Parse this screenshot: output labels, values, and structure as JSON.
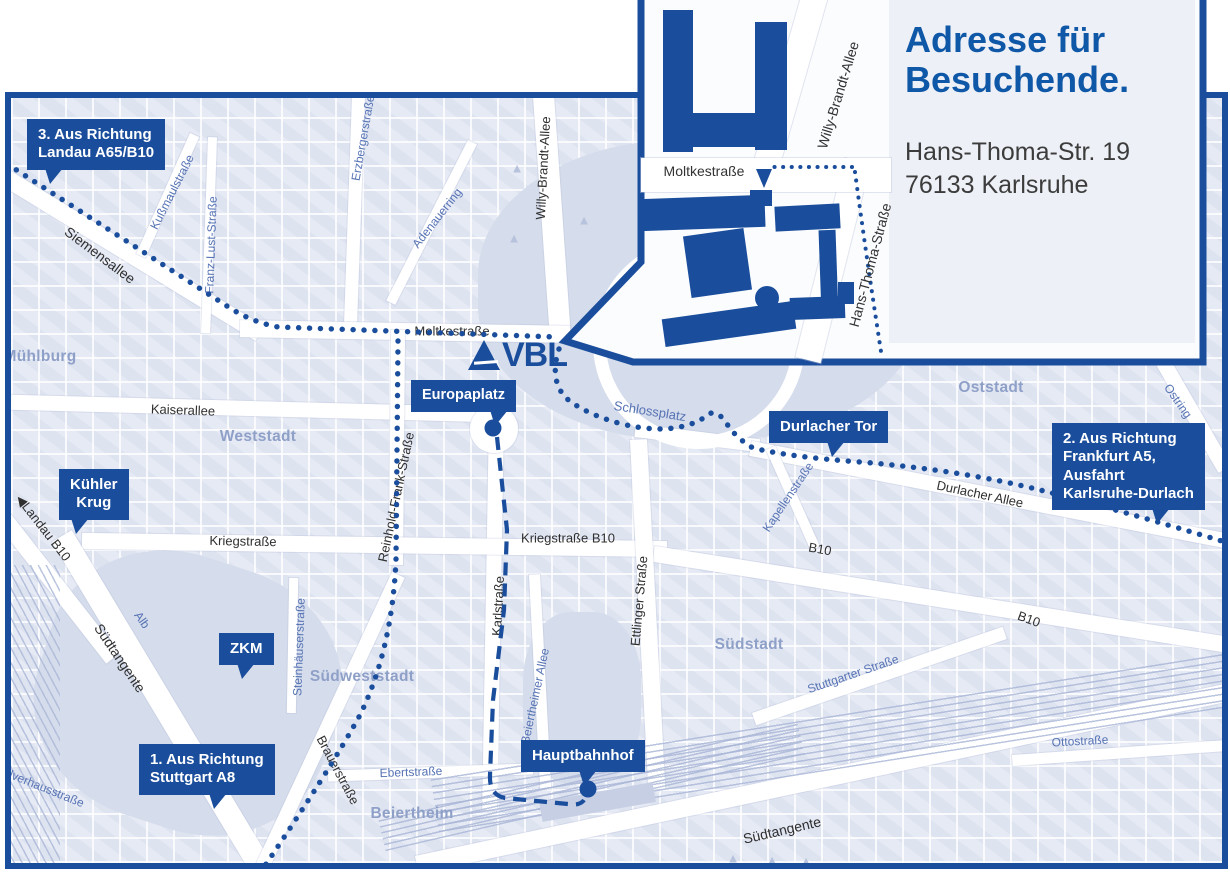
{
  "colors": {
    "brand_blue": "#1a4e9c",
    "title_blue": "#0f57a7",
    "map_block": "#dfe4f0",
    "map_park": "#d5dceb",
    "district_label": "#8fa0c8",
    "street_label_blue": "#5673b4",
    "street_label_dark": "#2f2f2f"
  },
  "logo": {
    "name": "VBL"
  },
  "icons": {
    "tree": "▲",
    "direction_arrow": "◀"
  },
  "inset": {
    "title_line1": "Adresse für",
    "title_line2": "Besuchende.",
    "address_line1": "Hans-Thoma-Str. 19",
    "address_line2": "76133 Karlsruhe",
    "streets": {
      "moltkestrasse": "Moltkestraße",
      "willy_brandt_allee": "Willy-Brandt-Allee",
      "hans_thoma_strasse": "Hans-Thoma-Straße"
    }
  },
  "badges": {
    "landau": {
      "line1": "3. Aus Richtung",
      "line2": "Landau A65/B10"
    },
    "kuehler_krug": {
      "line1": "Kühler",
      "line2": "Krug"
    },
    "zkm": {
      "line1": "ZKM"
    },
    "stuttgart": {
      "line1": "1. Aus Richtung",
      "line2": "Stuttgart A8"
    },
    "europaplatz": {
      "line1": "Europaplatz"
    },
    "durlacher_tor": {
      "line1": "Durlacher Tor"
    },
    "frankfurt": {
      "line1": "2. Aus Richtung",
      "line2": "Frankfurt A5,",
      "line3": "Ausfahrt",
      "line4": "Karlsruhe-Durlach"
    },
    "hauptbahnhof": {
      "line1": "Hauptbahnhof"
    }
  },
  "streets_dark": {
    "siemensallee": "Siemensallee",
    "moltkestrasse": "Moltkestraße",
    "kaiserallee": "Kaiserallee",
    "kriegstrasse": "Kriegstraße",
    "kriegstrasse_b10": "Kriegstraße B10",
    "karlstrasse": "Karlstraße",
    "reinhold_frank": "Reinhold-Frank-Straße",
    "brauerstrasse": "Brauerstraße",
    "durlacher_allee": "Durlacher Allee",
    "b10_mid": "B10",
    "b10_east": "B10",
    "suedtangente_west": "Südtangente",
    "suedtangente_sued": "Südtangente",
    "landau_b10": "Landau B10",
    "willy_brandt_allee": "Willy-Brandt-Allee",
    "ettlinger": "Ettlinger Straße"
  },
  "streets_blue": {
    "kussmaulstrasse": "Kußmaulstraße",
    "franz_lust": "Franz-Lust-Straße",
    "erzbergerstrasse": "Erzbergerstraße",
    "adenauerring": "Adenauerring",
    "schlossplatz": "Schlossplatz",
    "kapellenstrasse": "Kapellenstraße",
    "steinhaeuserstrasse": "Steinhäuserstraße",
    "beiertheimer_allee": "Beiertheimer Allee",
    "stuttgarter_strasse": "Stuttgarter Straße",
    "ottostrasse": "Ottostraße",
    "ostring": "Ostring",
    "alb": "Alb",
    "ebertstrasse": "Ebertstraße",
    "pulverhausstrasse": "Pulverhausstraße"
  },
  "districts": {
    "muehlburg": "Mühlburg",
    "weststadt": "Weststadt",
    "oststadt": "Oststadt",
    "suedstadt": "Südstadt",
    "suedweststadt": "Südweststadt",
    "beiertheim": "Beiertheim"
  }
}
